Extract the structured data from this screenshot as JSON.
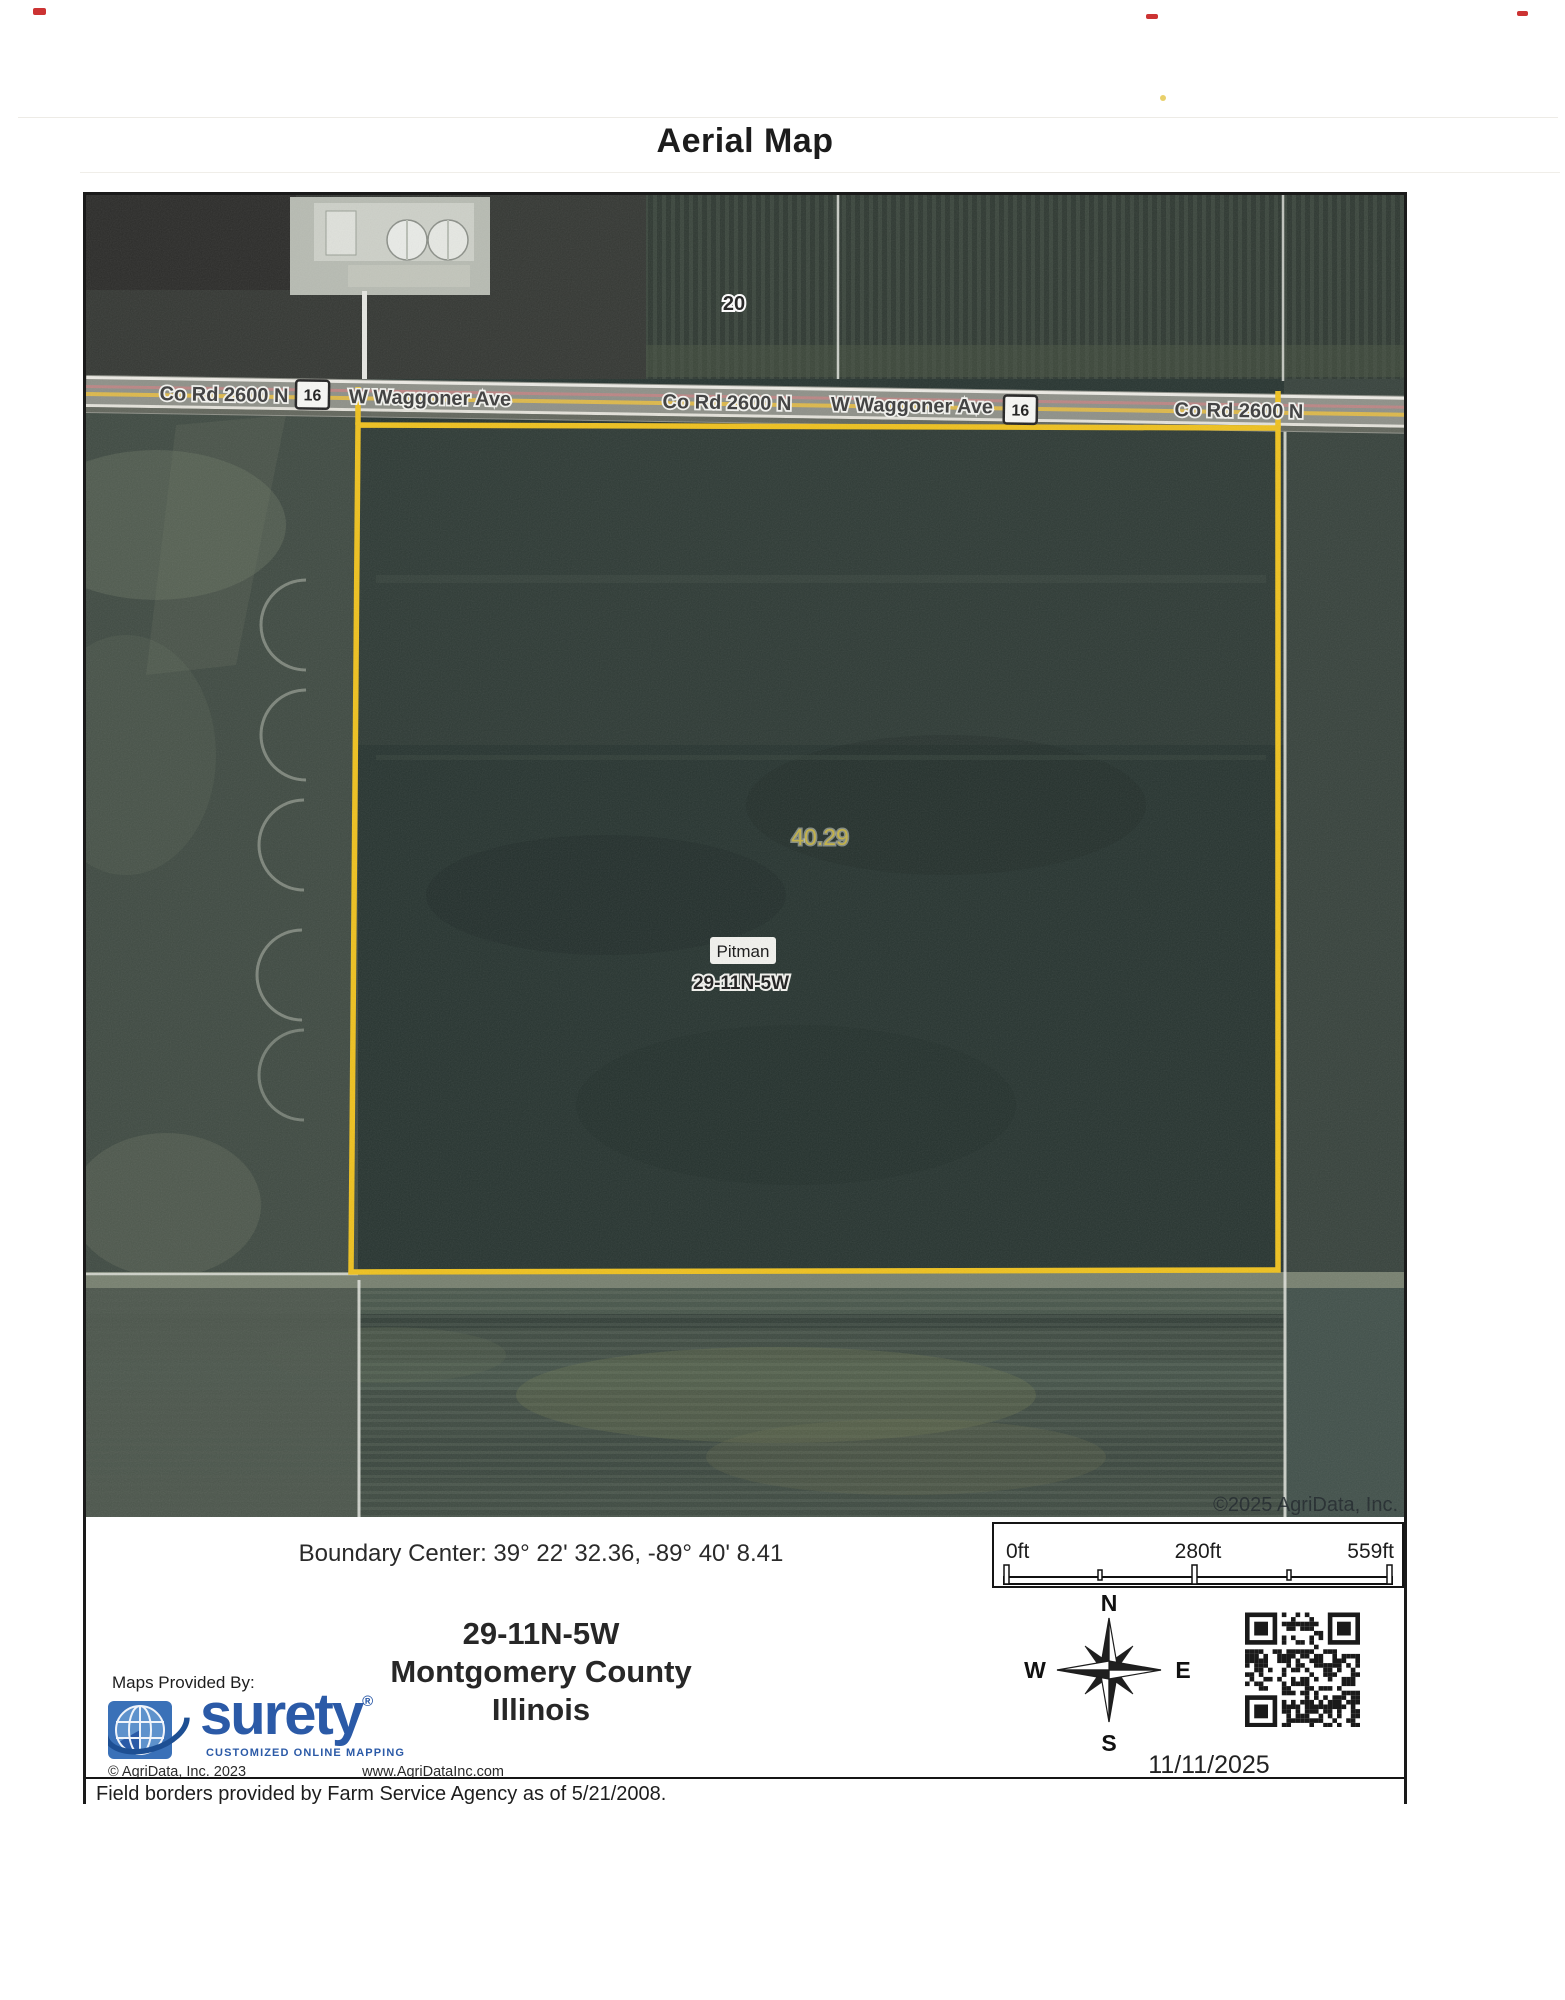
{
  "page": {
    "title": "Aerial Map"
  },
  "map": {
    "road": {
      "labels": [
        "Co Rd 2600 N",
        "W Waggoner Ave",
        "Co Rd 2600 N",
        "W Waggoner Ave",
        "Co Rd 2600 N"
      ],
      "shield": "16"
    },
    "section_number": "20",
    "acreage": "40.29",
    "town": "Pitman",
    "trs": "29-11N-5W",
    "watermark": "©2025 AgriData, Inc."
  },
  "info": {
    "boundary_center": "Boundary Center: 39° 22' 32.36, -89° 40' 8.41",
    "scale": {
      "start": "0ft",
      "mid": "280ft",
      "end": "559ft"
    },
    "legal": {
      "trs": "29-11N-5W",
      "county": "Montgomery County",
      "state": "Illinois"
    },
    "compass": {
      "n": "N",
      "s": "S",
      "e": "E",
      "w": "W"
    },
    "date": "11/11/2025"
  },
  "branding": {
    "maps_provided_by": "Maps Provided By:",
    "logo_text": "surety",
    "logo_registered": "®",
    "logo_tagline": "CUSTOMIZED ONLINE MAPPING",
    "copyright": "© AgriData, Inc. 2023",
    "website": "www.AgriDataInc.com"
  },
  "footer": {
    "note": "Field borders provided by Farm Service Agency as of 5/21/2008."
  },
  "colors": {
    "boundary_yellow": "#efc11d",
    "surety_blue": "#2b5aa7",
    "road_gray": "#8e9088",
    "field_dark": "#273430",
    "scan_mark_red": "#cc3333"
  }
}
